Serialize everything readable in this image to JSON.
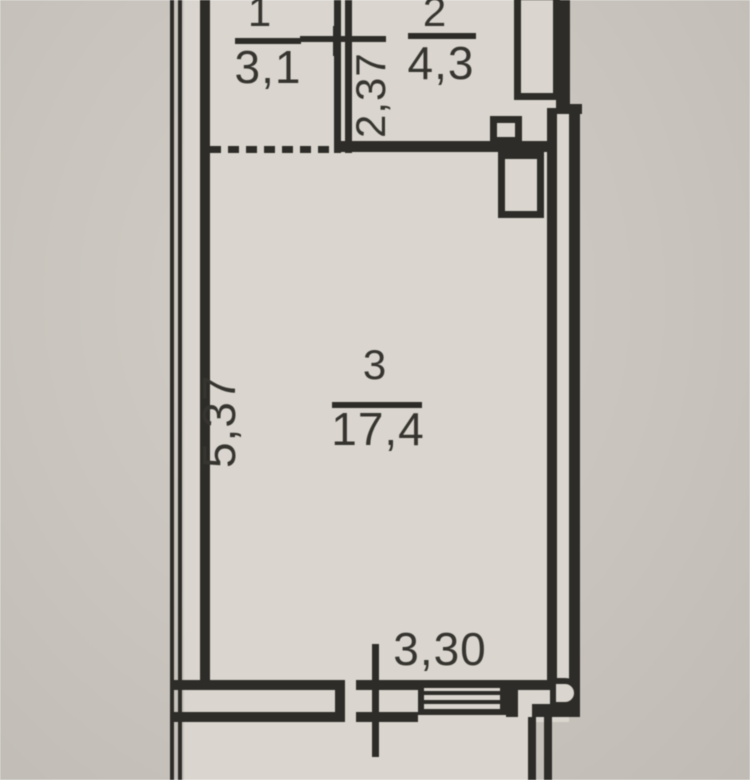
{
  "plan": {
    "rooms": [
      {
        "number": "1",
        "area": "3,1"
      },
      {
        "number": "2",
        "area": "4,3"
      },
      {
        "number": "3",
        "area": "17,4"
      }
    ],
    "dimensions": {
      "partition_wall_width": "2,37",
      "left_wall_length": "5,37",
      "bottom_wall_length": "3,30"
    },
    "colors": {
      "line": "#2e2c28",
      "ink": "#36342f",
      "room_fill": "#dad6cf",
      "paper": "#c9c5be",
      "paper_light": "#d2cec7",
      "paper_dark": "#c0bcb5"
    }
  }
}
